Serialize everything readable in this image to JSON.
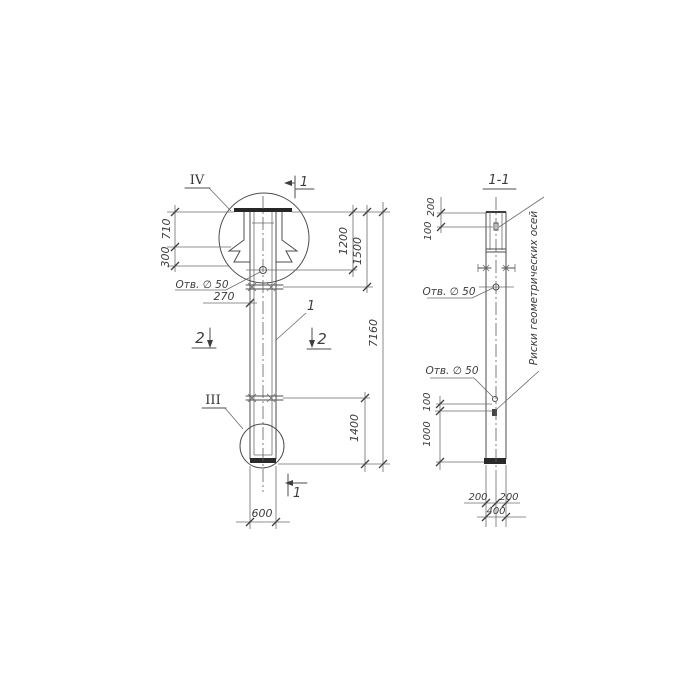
{
  "left_view": {
    "detail_top": "IV",
    "detail_bottom": "III",
    "part_label": "1",
    "section_mark_top": "1",
    "section_mark_bottom": "1",
    "section2_left": "2",
    "section2_right": "2",
    "hole_label": "Отв. ∅ 50",
    "dims": {
      "d710": "710",
      "d300": "300",
      "d270": "270",
      "d1200": "1200",
      "d1500": "1500",
      "d7160": "7160",
      "d1400": "1400",
      "d600": "600"
    }
  },
  "section_view": {
    "title": "1-1",
    "hole_label_upper": "Отв. ∅ 50",
    "hole_label_lower": "Отв. ∅ 50",
    "axes_note": "Риски геометрических осей",
    "dims": {
      "d200_top": "200",
      "d100_top": "100",
      "d100_mid": "100",
      "d1000": "1000",
      "d200_bottom_left": "200",
      "d200_bottom_right": "200",
      "d400": "400"
    }
  },
  "colors": {
    "background": "#ffffff",
    "line": "#4c4c4c",
    "thick_line": "#262626",
    "text": "#3c3c3c"
  }
}
